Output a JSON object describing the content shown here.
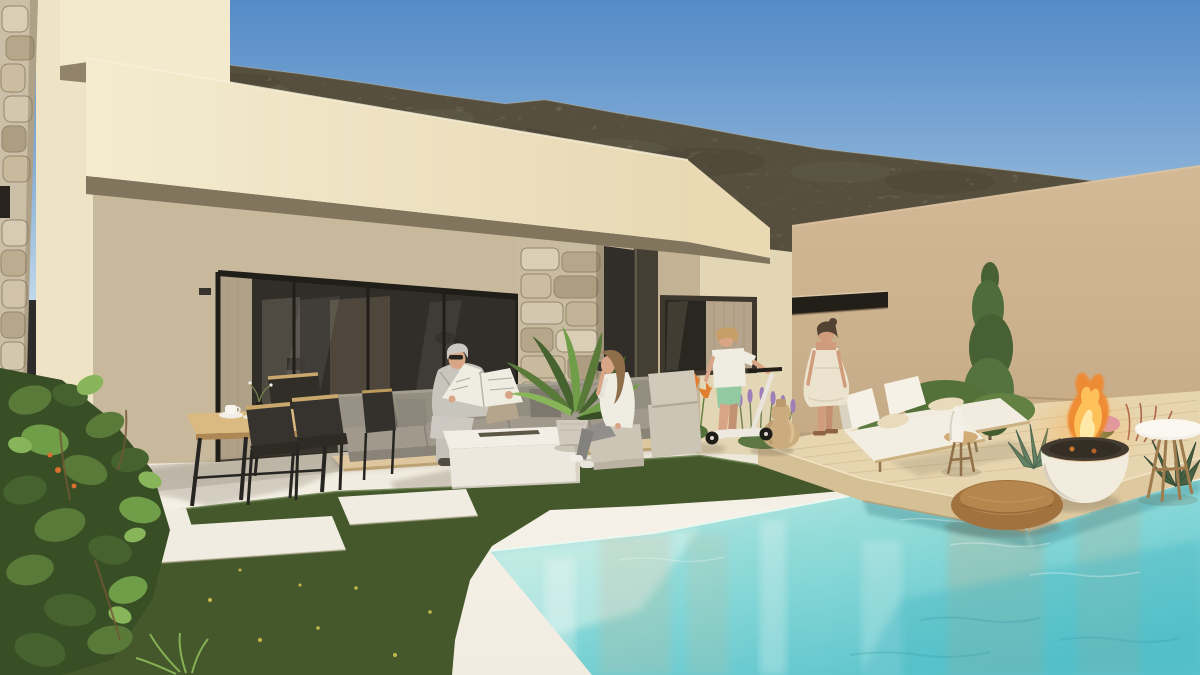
{
  "scene": {
    "description": "3D architectural rendering of a modern single-storey cream villa with covered patio, outdoor lounge and dining furniture, lawn with stepping stones, floating wooden deck with sun loungers and fire bowl, and a turquoise pool, set against a scrubby desert mountain under a clear blue sky",
    "time_of_day": "sunny daytime",
    "people": [
      {
        "id": "man-reading",
        "pose": "elderly man in light grey suit and sunglasses seated on sofa reading a newspaper"
      },
      {
        "id": "woman-phone",
        "pose": "young woman in white shirt and grey trousers seated on a pouf talking on the phone"
      },
      {
        "id": "boy-scooter",
        "pose": "boy in white t-shirt and mint shorts standing on a white kick scooter"
      },
      {
        "id": "woman-standing",
        "pose": "woman in a cream summer dress seen from behind walking toward the house"
      }
    ],
    "objects": [
      "mountain",
      "perimeter wall",
      "roof fascia",
      "glass sliding doors",
      "stone pillar",
      "picture window",
      "slit window",
      "dining table",
      "black chairs",
      "coffee cup",
      "corner sofa",
      "fire table",
      "palm plant",
      "ottomans",
      "lawn",
      "stepping stones",
      "wooden deck",
      "sun loungers",
      "fire bowl",
      "stone pouf",
      "side table",
      "amphora vase",
      "lavender",
      "agave",
      "cypress tree",
      "swimming pool"
    ]
  },
  "colors": {
    "sky_top": "#4b86c8",
    "sky_mid": "#7fabd8",
    "sky_horizon": "#bdd7ec",
    "mountain_base": "#8e8266",
    "mountain_dark": "#6e6450",
    "mountain_light": "#aa9f82",
    "wall_tan_top": "#d2b795",
    "wall_tan_bottom": "#bfa37e",
    "fascia_light": "#f4ebd0",
    "fascia_dark": "#e7d9b4",
    "fascia_end": "#e8dab4",
    "parapet": "#f3eacf",
    "soffit_shadow": "#7c6f59",
    "inner_wall": "#c6b79a",
    "left_wall": "#eee3c4",
    "glass_dark": "#262421",
    "right_wall": "#e2d5b4",
    "curtain": "#c3b196",
    "window_frame": "#332e26",
    "floor_light": "#f6f2ea",
    "floor_dark": "#e9e3d5",
    "lawn_green": "#5c7d36",
    "lawn_dark": "#44612a",
    "slab_white": "#f1ede3",
    "water_shallow": "#c8ece6",
    "water_mid": "#8fdcdb",
    "water_deep": "#52c2cd",
    "deck_top": "#e6d4ae",
    "deck_face": "#d3bd92",
    "platform_wood": "#ddc69c",
    "table_wood": "#d8b87e",
    "chair_black": "#2c2a26",
    "sofa_gray": "#8f897e",
    "sofa_seat": "#9b958a",
    "fire_orange": "#f08327",
    "fire_yellow": "#ffc257",
    "bowl_white": "#f1ece0",
    "pouf_brown": "#9c6c36",
    "ottoman_beige": "#cac3b5",
    "suit_gray": "#c6c3bd",
    "skin_tone": "#d7a284",
    "shirt_white": "#efece4",
    "shorts_mint": "#8fc9a0",
    "dress_cream": "#ebe3cf",
    "hair_brown": "#8a6844",
    "hair_gray": "#c9c7c2",
    "hair_dark": "#4a3a2c",
    "scooter_white": "#e8e5de",
    "cypress_green": "#3e5a2e",
    "lavender_purple": "#9a7ab8",
    "flower_orange": "#e07828",
    "flower_pink": "#c06a9a",
    "vase_tan": "#c9a97c",
    "stone_light": "#d8cdb6",
    "stone_mid": "#b3a488",
    "column_dark": "#3b352c",
    "stool_wood": "#cfa972",
    "towel_cream": "#e8dabc"
  }
}
